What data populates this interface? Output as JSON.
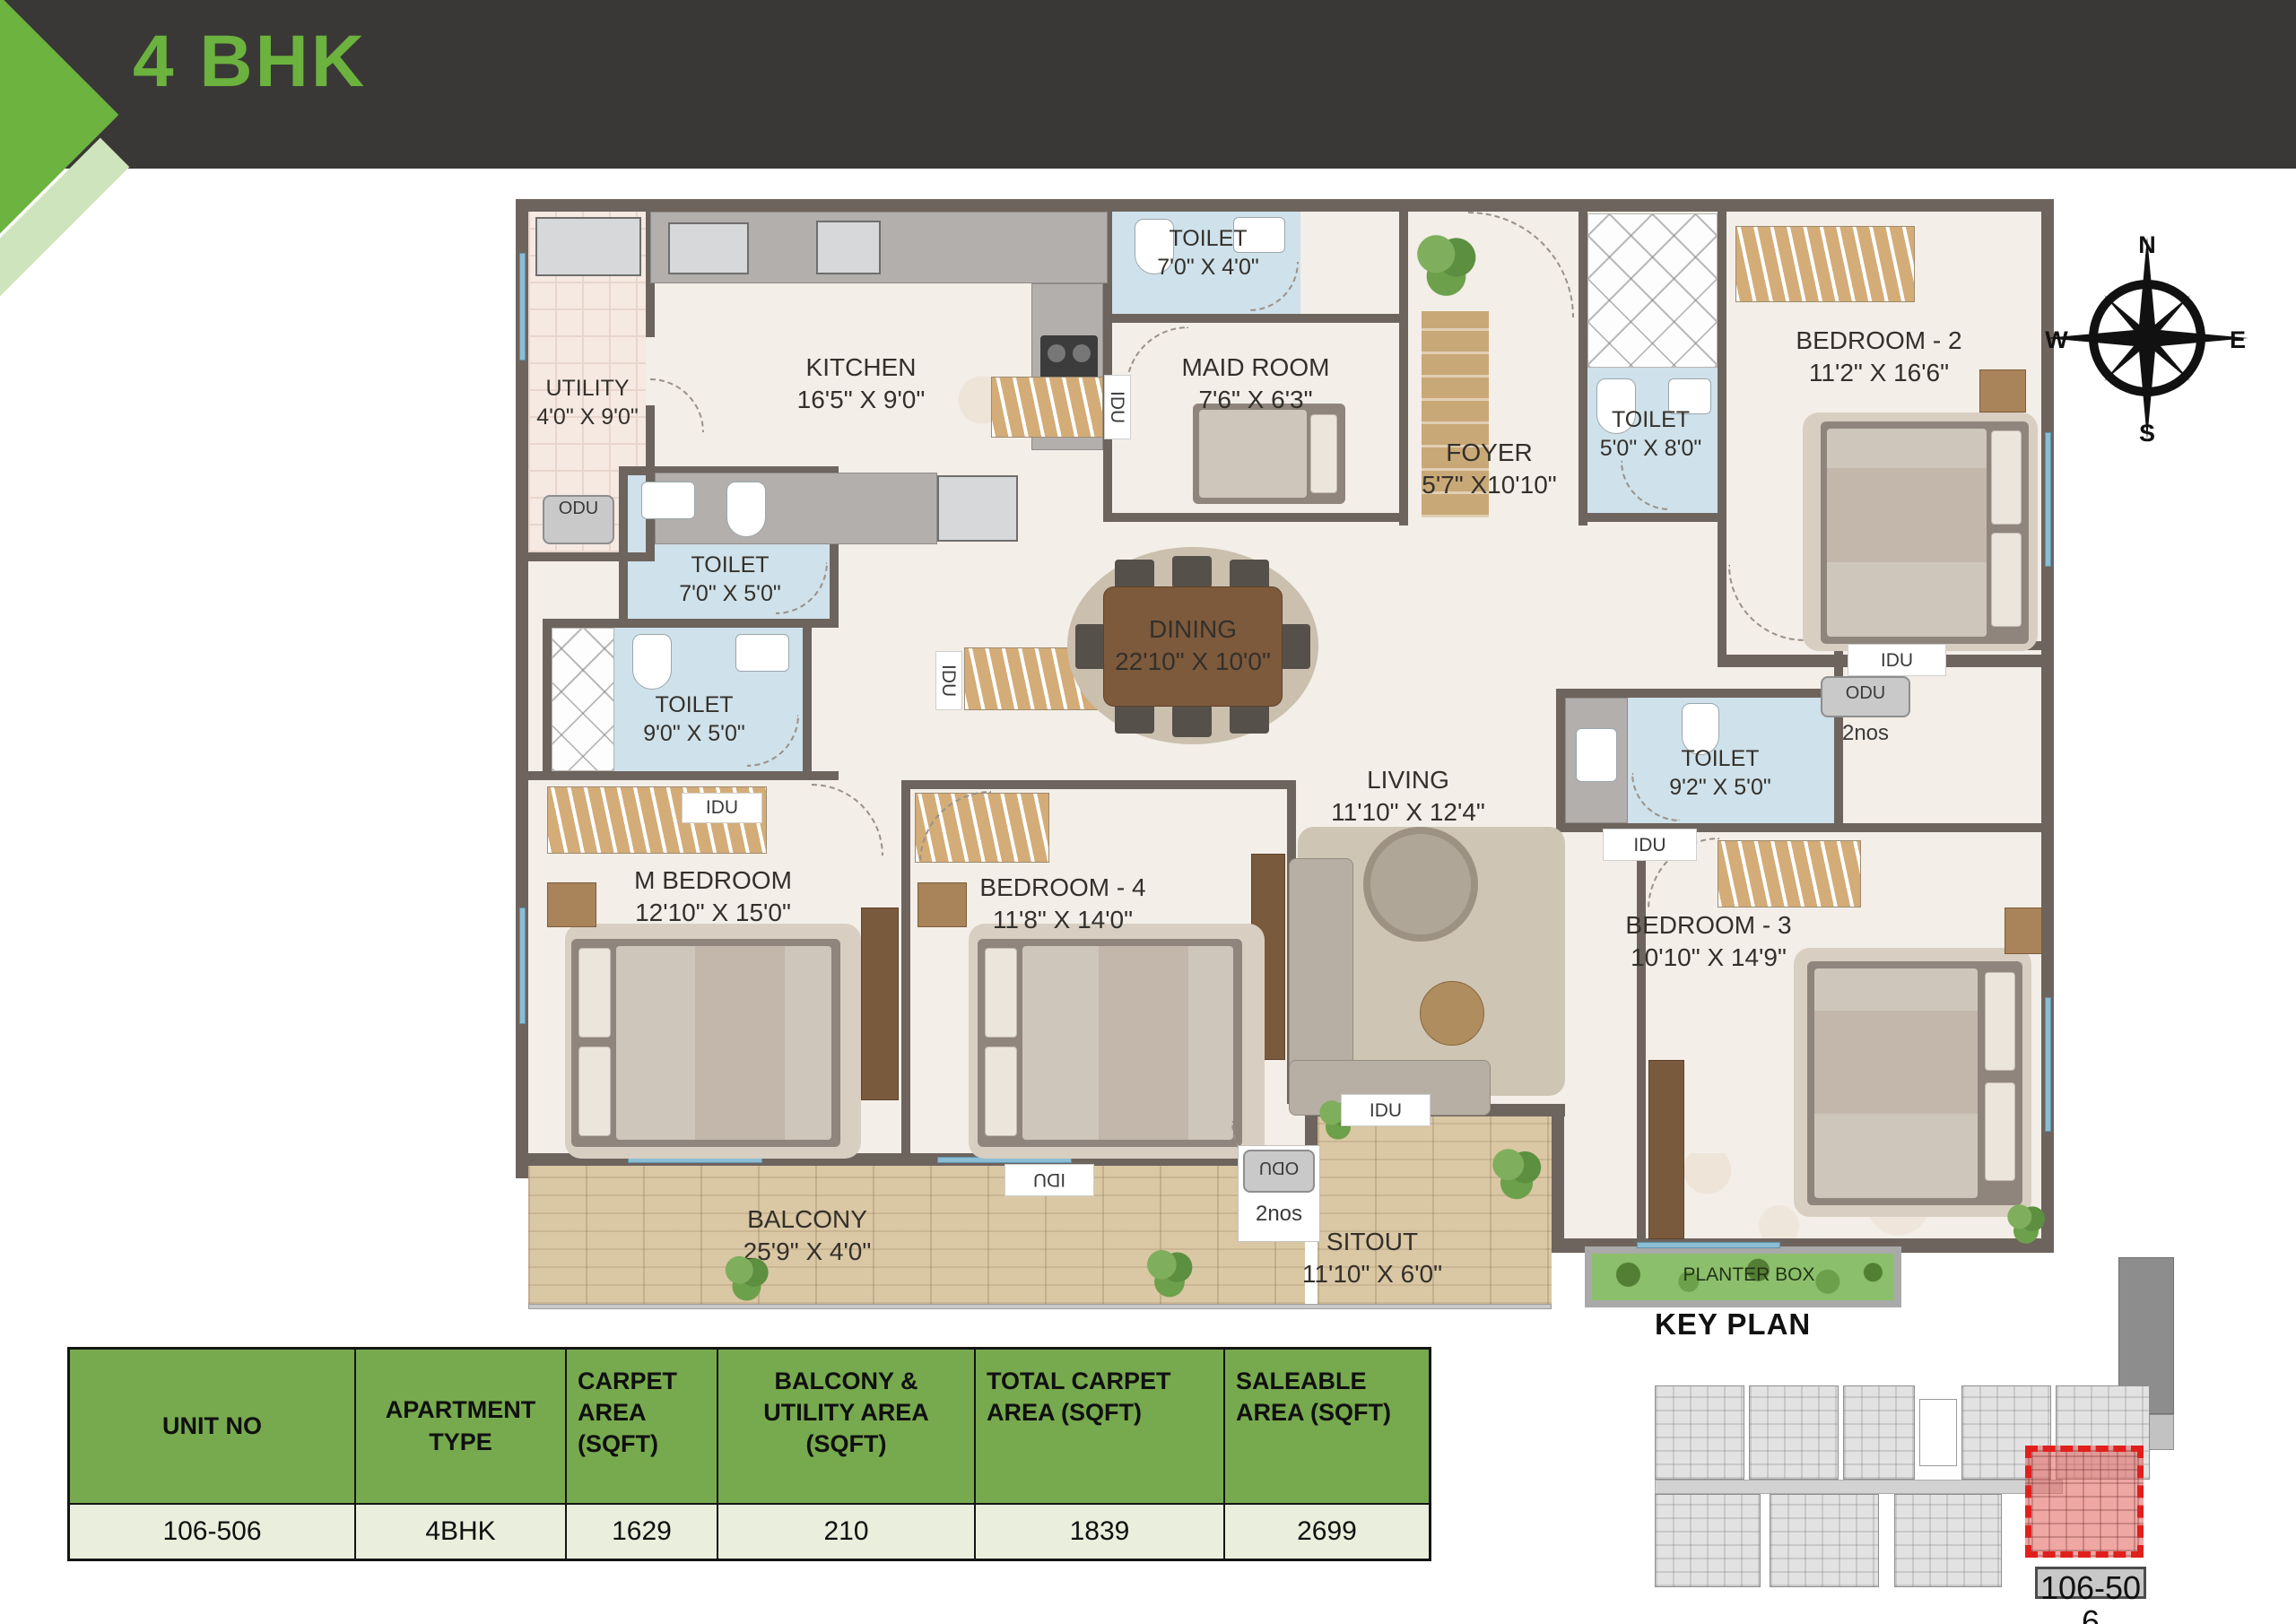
{
  "header": {
    "title": "4 BHK"
  },
  "compass": {
    "n": "N",
    "e": "E",
    "s": "S",
    "w": "W"
  },
  "floorplan": {
    "rooms": [
      {
        "name": "UTILITY",
        "dims": "4'0\" X 9'0\""
      },
      {
        "name": "KITCHEN",
        "dims": "16'5\" X 9'0\""
      },
      {
        "name": "TOILET",
        "dims": "7'0\" X 4'0\""
      },
      {
        "name": "MAID ROOM",
        "dims": "7'6\" X 6'3\""
      },
      {
        "name": "FOYER",
        "dims": "5'7\" X10'10\""
      },
      {
        "name": "TOILET",
        "dims": "5'0\" X 8'0\""
      },
      {
        "name": "BEDROOM - 2",
        "dims": "11'2\" X 16'6\""
      },
      {
        "name": "TOILET",
        "dims": "7'0\" X 5'0\""
      },
      {
        "name": "TOILET",
        "dims": "9'0\" X 5'0\""
      },
      {
        "name": "DINING",
        "dims": "22'10\" X 10'0\""
      },
      {
        "name": "LIVING",
        "dims": "11'10\" X 12'4\""
      },
      {
        "name": "TOILET",
        "dims": "9'2\" X 5'0\""
      },
      {
        "name": "M BEDROOM",
        "dims": "12'10\" X 15'0\""
      },
      {
        "name": "BEDROOM - 4",
        "dims": "11'8\" X 14'0\""
      },
      {
        "name": "BEDROOM - 3",
        "dims": "10'10\" X 14'9\""
      },
      {
        "name": "BALCONY",
        "dims": "25'9\" X 4'0\""
      },
      {
        "name": "SITOUT",
        "dims": "11'10\" X 6'0\""
      }
    ],
    "tags": {
      "idu": "IDU",
      "odu": "ODU",
      "qty": "2nos",
      "planter": "PLANTER BOX"
    }
  },
  "table": {
    "headers": [
      "UNIT NO",
      "APARTMENT TYPE",
      "CARPET AREA (SQFT)",
      "BALCONY & UTILITY AREA (SQFT)",
      "TOTAL CARPET AREA (SQFT)",
      "SALEABLE AREA (SQFT)"
    ],
    "rows": [
      [
        "106-506",
        "4BHK",
        "1629",
        "210",
        "1839",
        "2699"
      ]
    ]
  },
  "keyplan": {
    "title": "KEY PLAN",
    "unit_label": "106-506"
  },
  "colors": {
    "accent_green": "#6cb33f",
    "table_header_green": "#77aa4e",
    "highlight_red": "#e0201d",
    "wall": "#6d645e",
    "toilet_blue": "#cfe1ea"
  }
}
